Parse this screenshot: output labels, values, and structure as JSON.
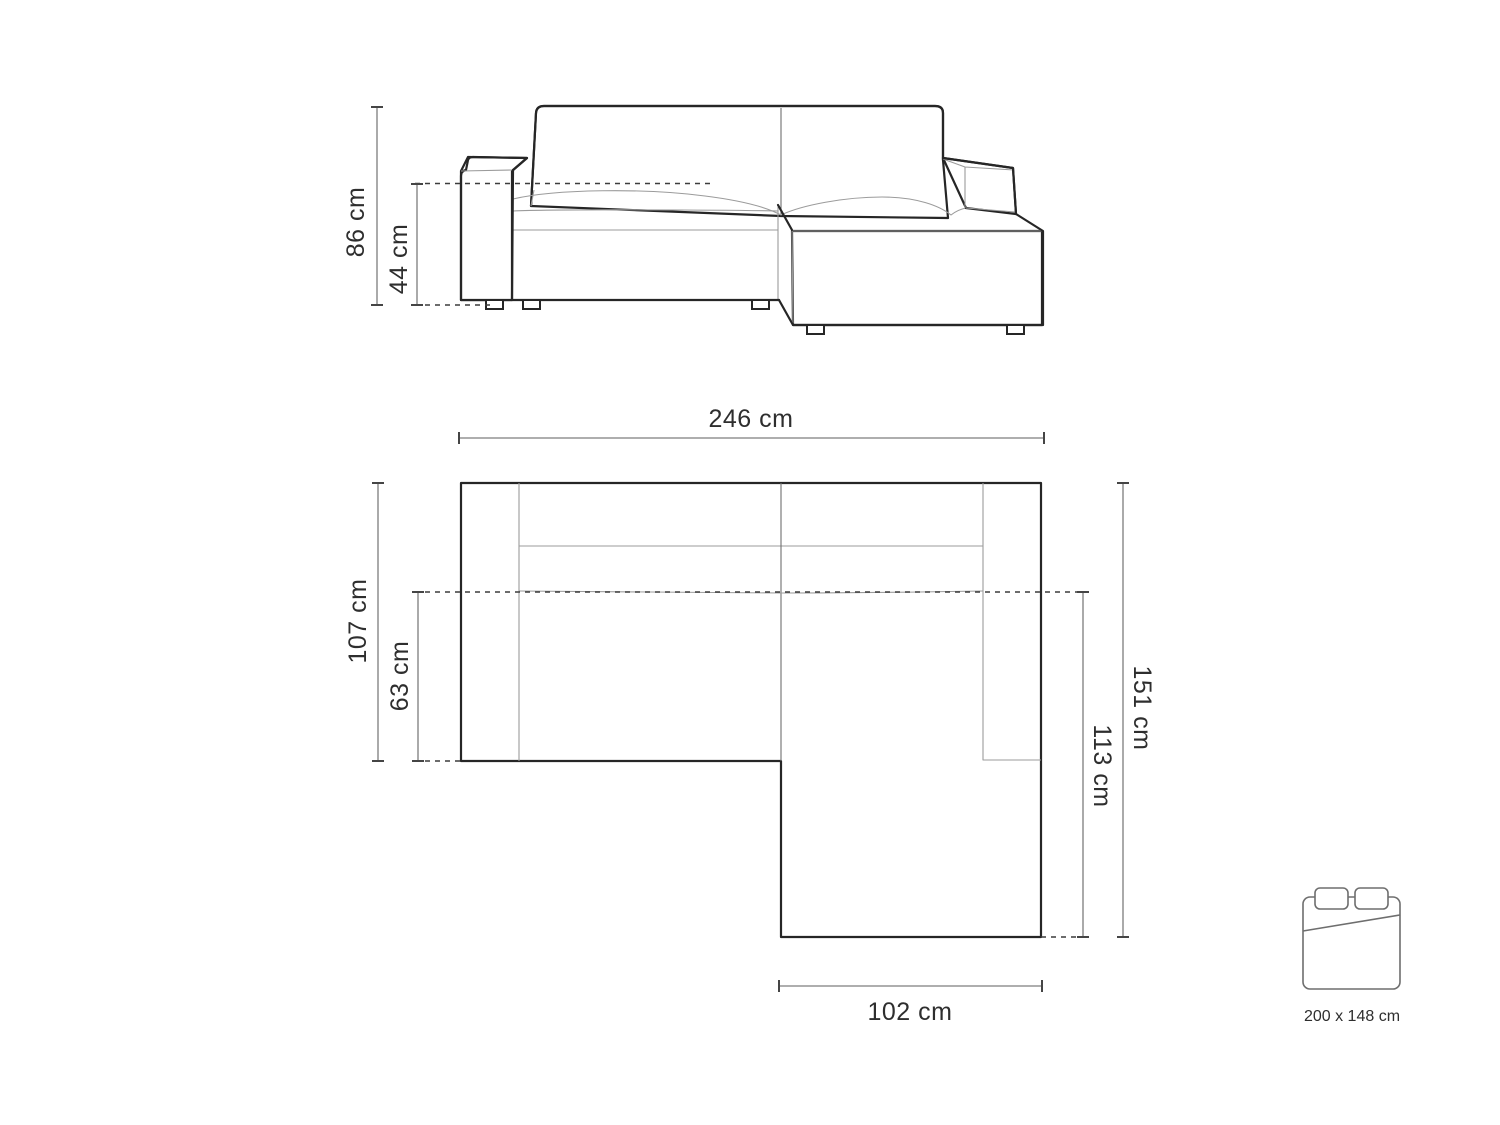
{
  "diagram": {
    "type": "corner-sofa-dimension-diagram",
    "colors": {
      "background": "#ffffff",
      "outline": "#262626",
      "thin_line": "#9b9b9b",
      "dimension_line": "#7d7d7d",
      "dashed_line": "#3c3c3c",
      "text": "#2e2e2e"
    },
    "front_view": {
      "dimensions": [
        {
          "id": "total_height",
          "label": "86 cm"
        },
        {
          "id": "seat_height",
          "label": "44 cm"
        }
      ]
    },
    "top_view": {
      "dimensions": [
        {
          "id": "total_width",
          "label": "246 cm"
        },
        {
          "id": "body_depth",
          "label": "107 cm"
        },
        {
          "id": "seat_depth",
          "label": "63 cm"
        },
        {
          "id": "total_depth",
          "label": "151 cm"
        },
        {
          "id": "chaise_depth",
          "label": "113 cm"
        },
        {
          "id": "chaise_width",
          "label": "102 cm"
        }
      ]
    },
    "sleeping_area": {
      "label": "200 x 148 cm"
    }
  }
}
